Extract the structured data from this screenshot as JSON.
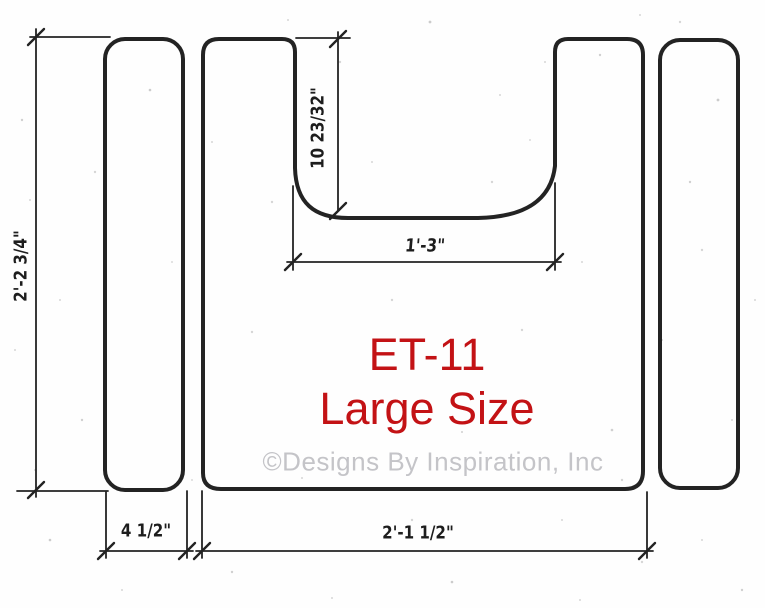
{
  "drawing": {
    "title": {
      "code": "ET-11",
      "size_label": "Large Size"
    },
    "watermark": "©Designs By Inspiration, Inc",
    "dimensions": {
      "overall_height": "2'-2 3/4\"",
      "notch_depth": "10 23/32\"",
      "notch_width": "1'-3\"",
      "side_strip_width": "4 1/2\"",
      "overall_width": "2'-1 1/2\""
    },
    "colors": {
      "line": "#232323",
      "title_red": "#c31215",
      "watermark_gray": "#c4c4c8",
      "paper": "#fefefe"
    }
  }
}
